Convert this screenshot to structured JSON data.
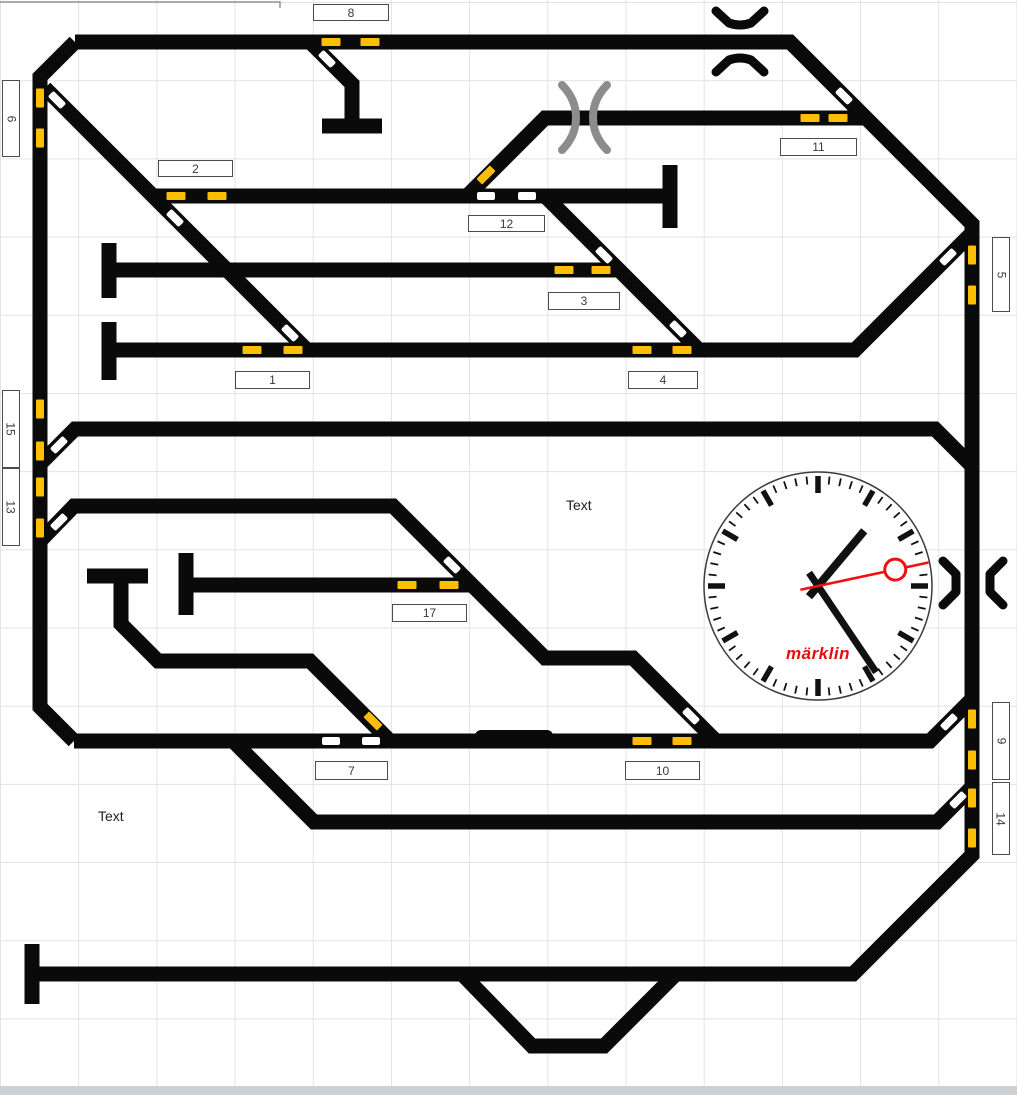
{
  "colors": {
    "track": "#0a0a0a",
    "marker_yellow": "#fcbe03",
    "turnout_white": "#ffffff",
    "portal_gray": "#8c8c8c",
    "portal_black": "#0a0a0a",
    "logo_red": "#e60d0d",
    "grid": "#e1e3e5"
  },
  "labels": [
    {
      "text": "8",
      "x": 313,
      "y": 4,
      "w": 76,
      "h": 17,
      "vertical": false
    },
    {
      "text": "6",
      "x": 2,
      "y": 80,
      "w": 18,
      "h": 77,
      "vertical": true
    },
    {
      "text": "2",
      "x": 158,
      "y": 160,
      "w": 75,
      "h": 17,
      "vertical": false
    },
    {
      "text": "11",
      "x": 780,
      "y": 138,
      "w": 77,
      "h": 18,
      "vertical": false
    },
    {
      "text": "12",
      "x": 468,
      "y": 215,
      "w": 77,
      "h": 17,
      "vertical": false
    },
    {
      "text": "5",
      "x": 992,
      "y": 237,
      "w": 18,
      "h": 75,
      "vertical": true
    },
    {
      "text": "3",
      "x": 548,
      "y": 292,
      "w": 72,
      "h": 18,
      "vertical": false
    },
    {
      "text": "1",
      "x": 235,
      "y": 371,
      "w": 75,
      "h": 18,
      "vertical": false
    },
    {
      "text": "4",
      "x": 628,
      "y": 371,
      "w": 70,
      "h": 18,
      "vertical": false
    },
    {
      "text": "15",
      "x": 2,
      "y": 390,
      "w": 18,
      "h": 78,
      "vertical": true
    },
    {
      "text": "13",
      "x": 2,
      "y": 468,
      "w": 18,
      "h": 78,
      "vertical": true
    },
    {
      "text": "17",
      "x": 392,
      "y": 604,
      "w": 75,
      "h": 18,
      "vertical": false
    },
    {
      "text": "7",
      "x": 315,
      "y": 761,
      "w": 73,
      "h": 19,
      "vertical": false
    },
    {
      "text": "10",
      "x": 625,
      "y": 761,
      "w": 75,
      "h": 19,
      "vertical": false
    },
    {
      "text": "9",
      "x": 992,
      "y": 702,
      "w": 18,
      "h": 78,
      "vertical": true
    },
    {
      "text": "14",
      "x": 992,
      "y": 782,
      "w": 18,
      "h": 73,
      "vertical": true
    }
  ],
  "annotations": [
    {
      "text": "Text",
      "x": 566,
      "y": 497
    },
    {
      "text": "Text",
      "x": 98,
      "y": 808
    }
  ],
  "clock": {
    "cx": 818,
    "cy": 586,
    "r": 114,
    "hour_angle": 40,
    "minute_angle": 146,
    "second_angle": 78,
    "second_color": "#ee1111",
    "logo": "märklin",
    "logo_color": "#e60d0d"
  }
}
